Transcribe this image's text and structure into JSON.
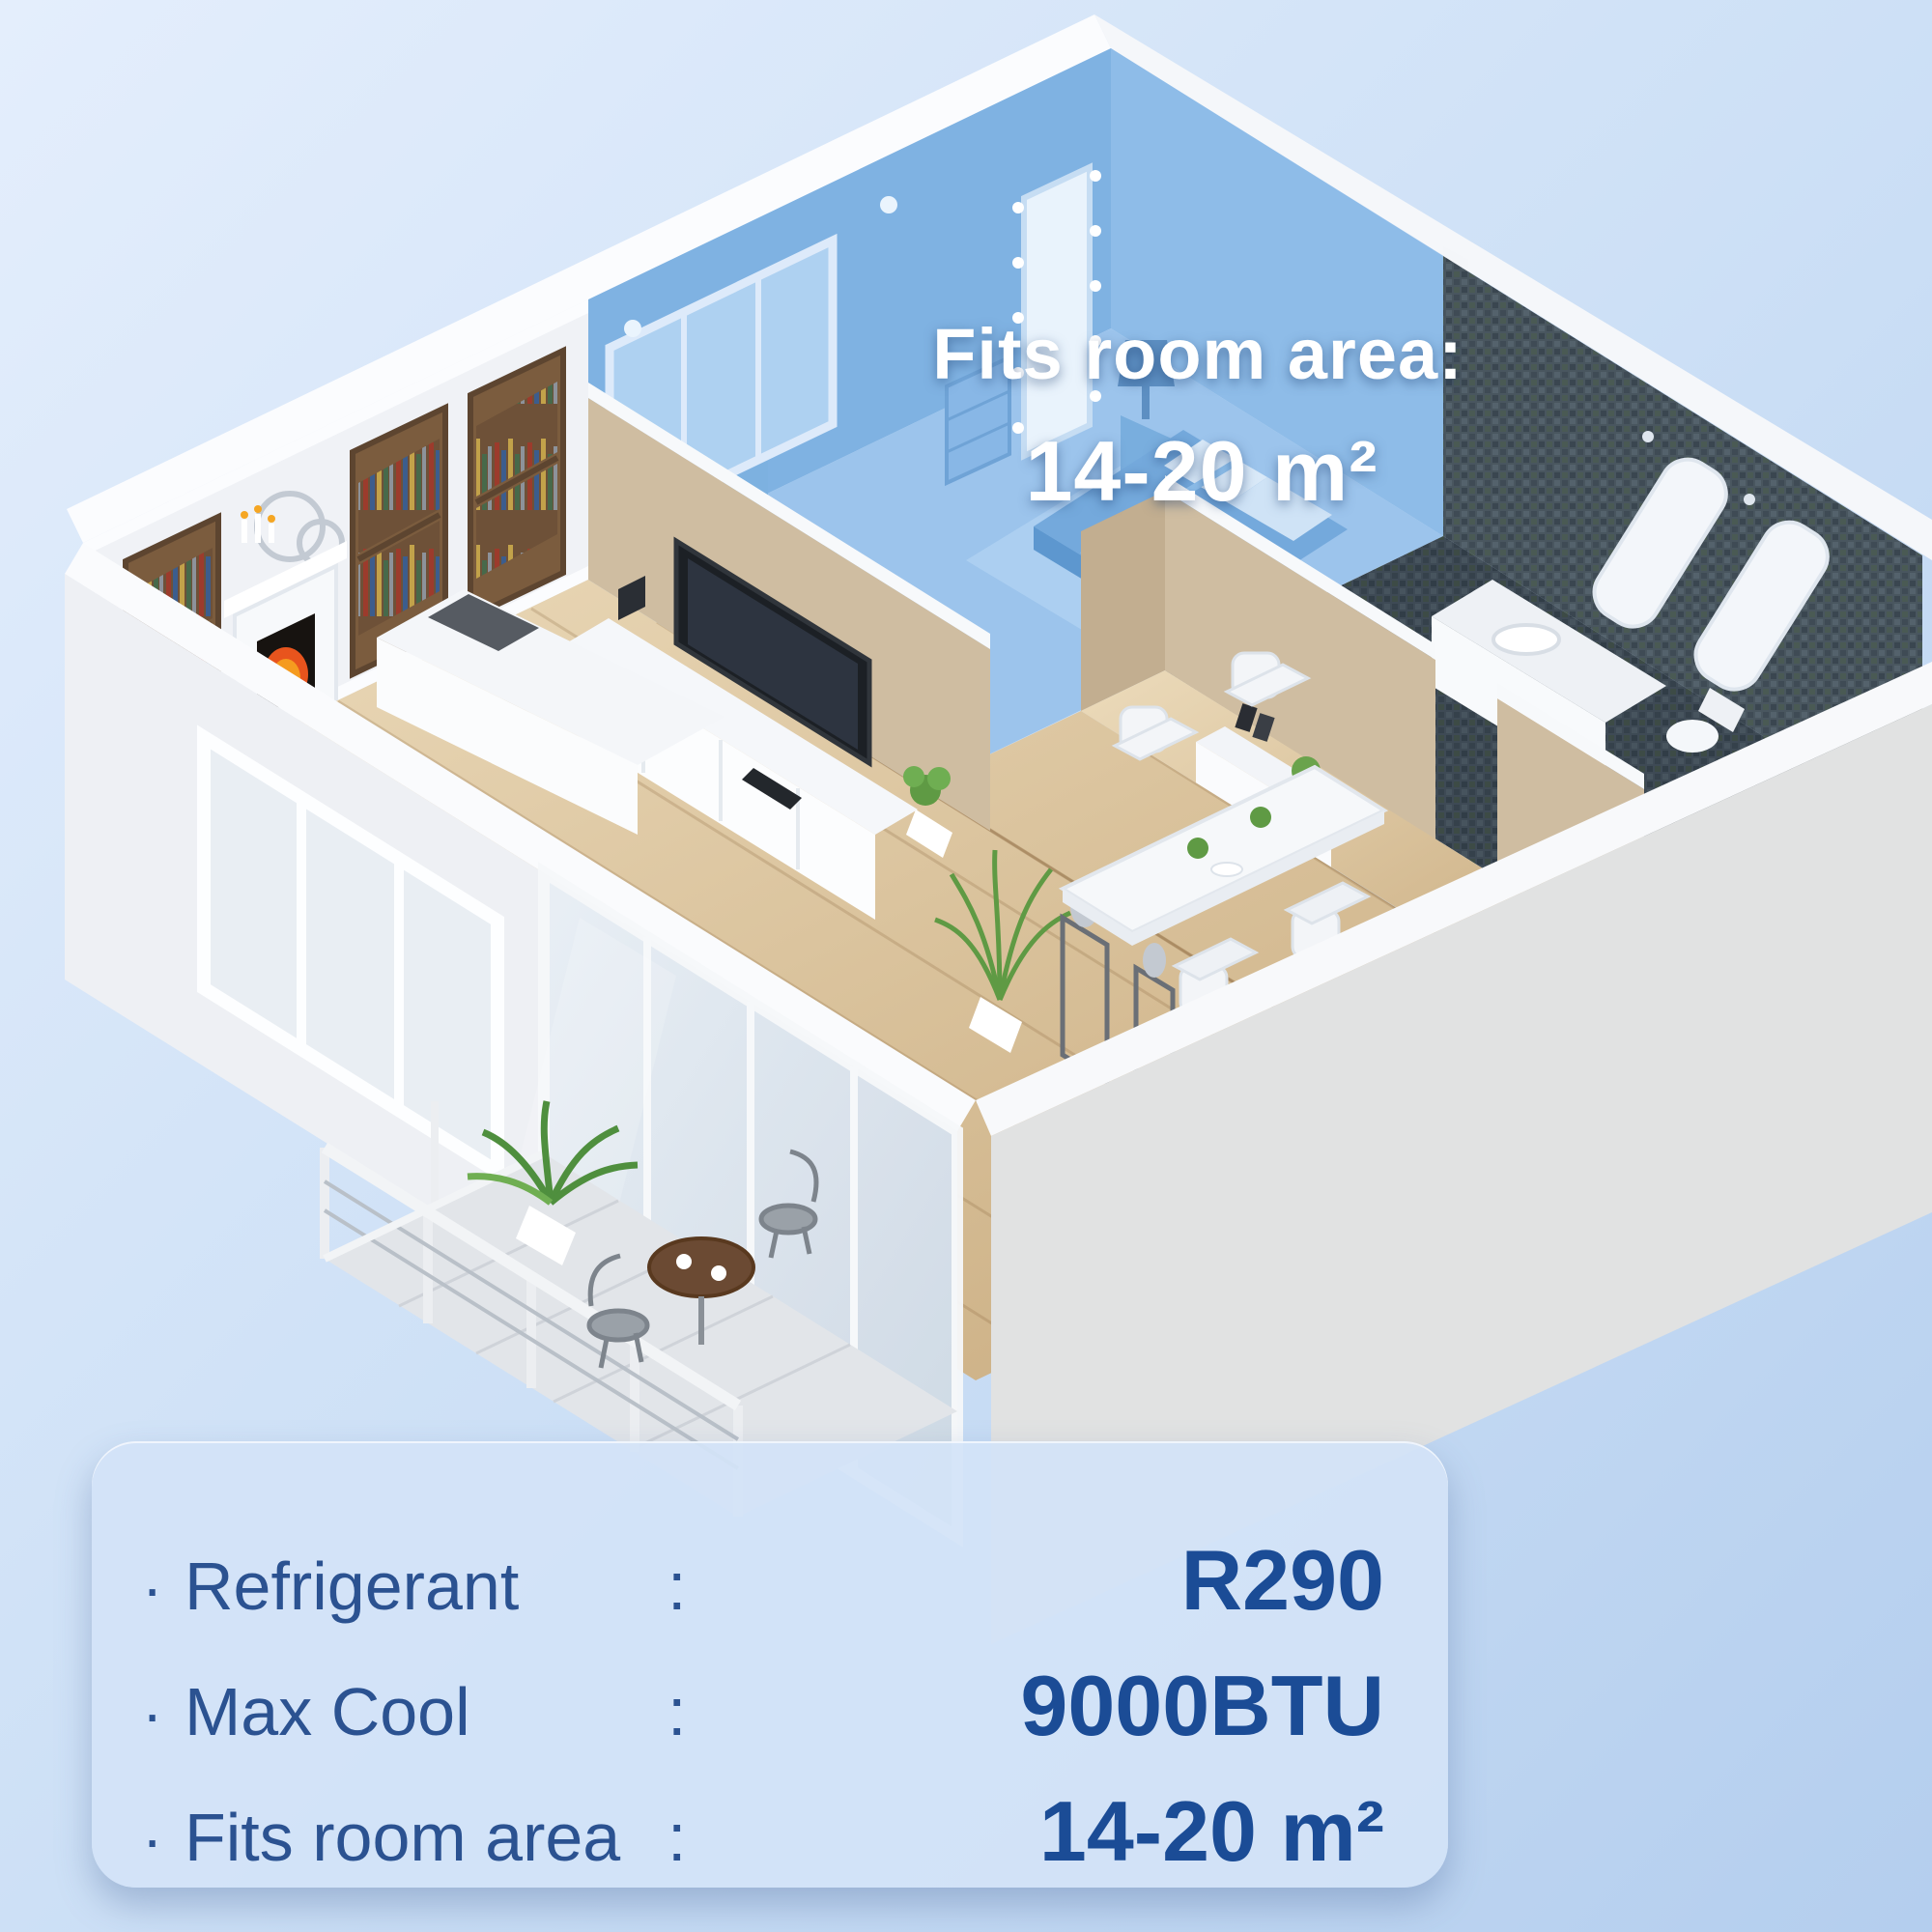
{
  "overlay": {
    "title": "Fits room area:",
    "value": "14-20 m²"
  },
  "panel": {
    "rows": [
      {
        "bullet": "·",
        "label": "Refrigerant",
        "colon": ":",
        "value": "R290"
      },
      {
        "bullet": "·",
        "label": "Max Cool",
        "colon": ":",
        "value": "9000BTU"
      },
      {
        "bullet": "·",
        "label": "Fits room area",
        "colon": ":",
        "value": "14-20 m²"
      }
    ]
  },
  "colors": {
    "background_top": "#E3EDFC",
    "background_bottom": "#B6CFEF",
    "room_highlight_blue": "#7FB2E2",
    "overlay_text": "#FFFFFF",
    "panel_background": "#D3E3F7",
    "label_text": "#2B5291",
    "value_text": "#1B4C96",
    "wood_floor": "#D8BF98",
    "mosaic_tile": "#49565F",
    "tan_wall": "#CFBDA1",
    "white_wall": "#F1F3F7"
  }
}
